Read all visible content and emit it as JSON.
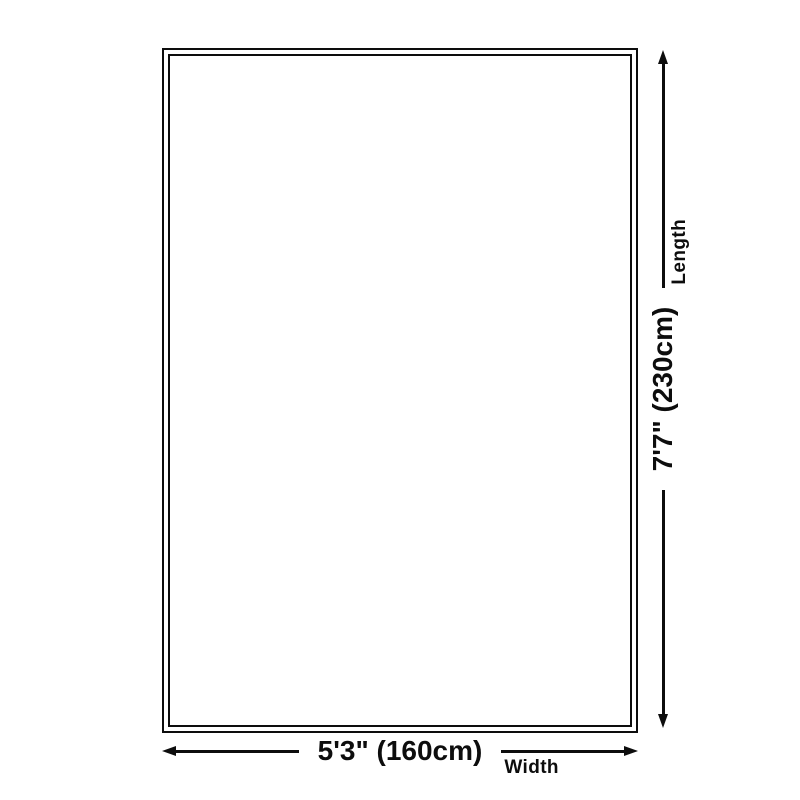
{
  "diagram": {
    "type": "product-size-diagram",
    "colors": {
      "background": "#ffffff",
      "line": "#0d0d0d",
      "text": "#0d0d0d"
    },
    "dimensions": {
      "width": {
        "value": "5'3\" (160cm)",
        "label": "Width"
      },
      "length": {
        "value": "7'7\" (230cm)",
        "label": "Length"
      }
    }
  }
}
